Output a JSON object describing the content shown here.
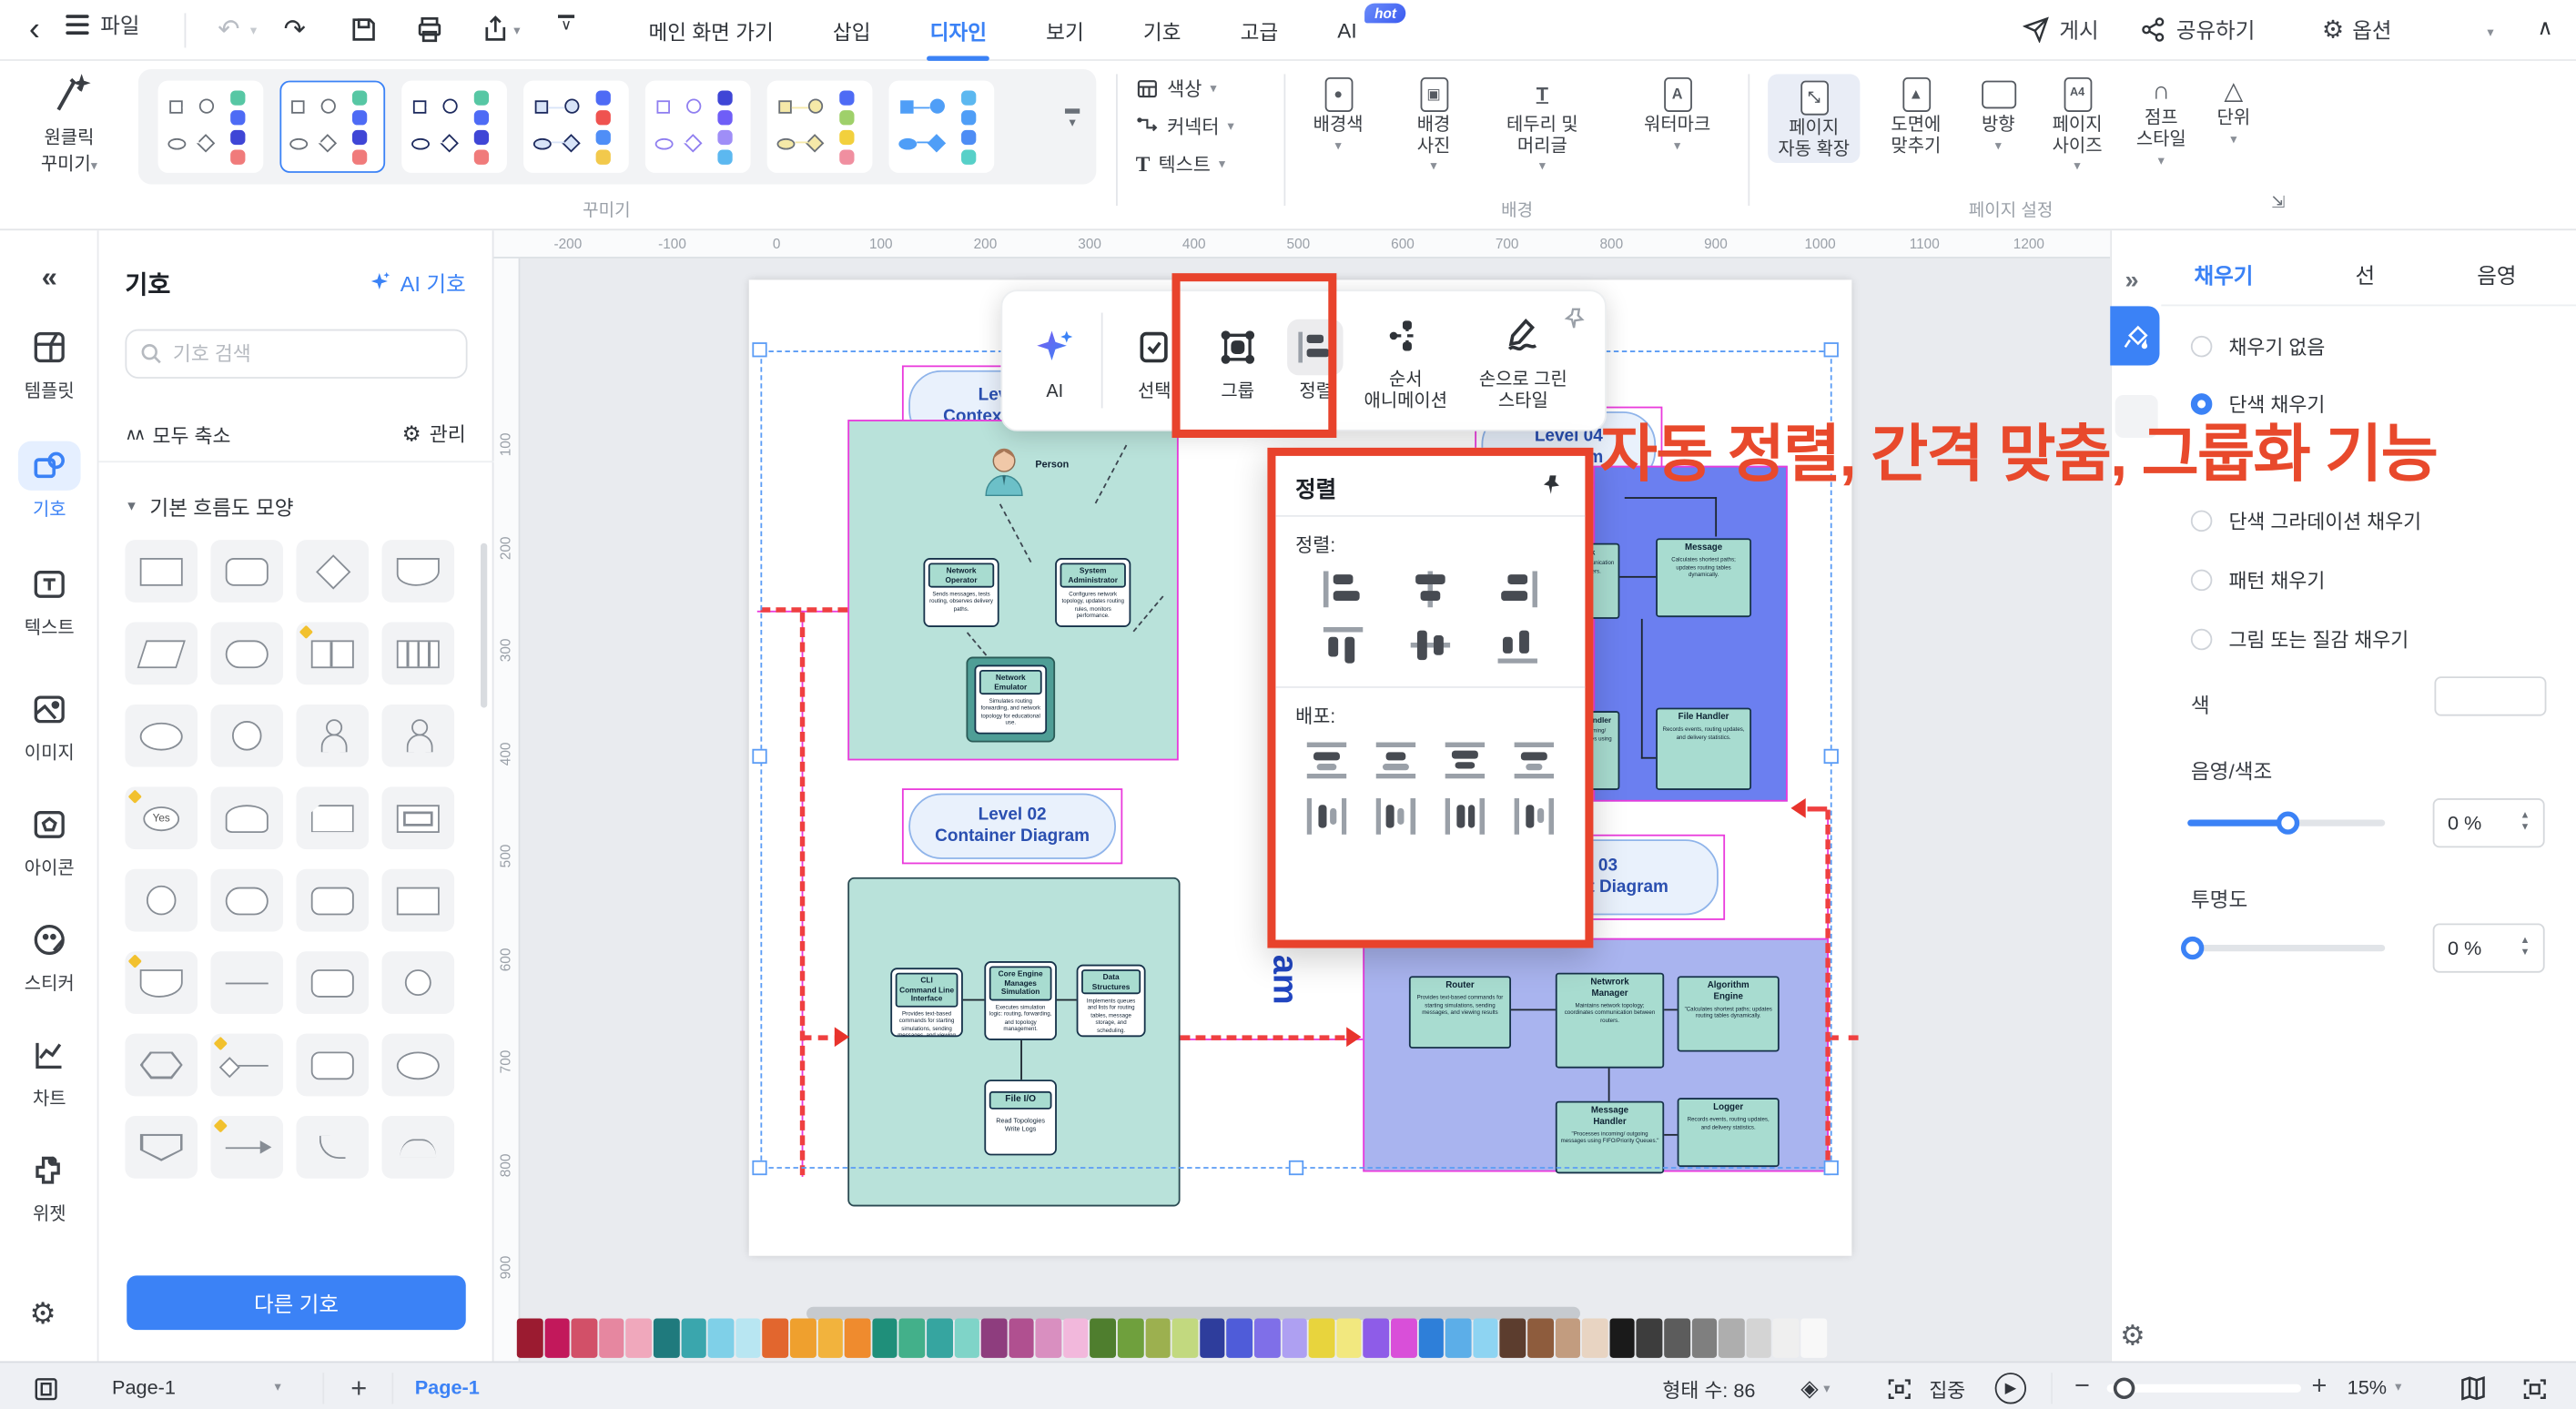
{
  "theme": {
    "accent": "#3b82f6",
    "magenta": "#ea3bdc",
    "red_dash": "#ef4040",
    "annotation_red": "#e8492c"
  },
  "topbar": {
    "file": "파일",
    "tabs": [
      {
        "label": "메인 화면 가기"
      },
      {
        "label": "삽입"
      },
      {
        "label": "디자인"
      },
      {
        "label": "보기"
      },
      {
        "label": "기호"
      },
      {
        "label": "고급"
      },
      {
        "label": "AI"
      }
    ],
    "ai_badge": "hot",
    "publish": "게시",
    "share": "공유하기",
    "options": "옵션",
    "help": "?",
    "glyphs": {
      "back": "‹",
      "undo": "↶",
      "redo": "↷",
      "caret": "▾",
      "collapse_up": "∧",
      "gear": "⚙"
    }
  },
  "ribbon": {
    "oneclick": "원클릭\n꾸미기",
    "decorate_group": "꾸미기",
    "bg_group": "배경",
    "page_group": "페이지 설정",
    "color": "색상",
    "connector": "커넥터",
    "text": "텍스트",
    "bg_color": "배경색",
    "bg_photo": "배경\n사진",
    "border_header": "테두리 및\n머리글",
    "watermark": "워터마크",
    "auto_expand": "페이지\n자동 확장",
    "fit_drawing": "도면에\n맞추기",
    "orientation": "방향",
    "page_size": "페이지\n사이즈",
    "jump_style": "점프\n스타일",
    "unit": "단위",
    "presets": [
      {
        "style": "st-outline-gray",
        "selected": false,
        "dots": [
          "#57c7a4",
          "#4e6bf5",
          "#3f46d6",
          "#f07b7b"
        ]
      },
      {
        "style": "st-outline-gray",
        "selected": true,
        "dots": [
          "#57c7a4",
          "#4e6bf5",
          "#3f46d6",
          "#f07b7b"
        ]
      },
      {
        "style": "st-outline-navy",
        "selected": false,
        "dots": [
          "#57c7a4",
          "#4e6bf5",
          "#3f46d6",
          "#f07b7b"
        ]
      },
      {
        "style": "st-fill-blue-outline",
        "selected": false,
        "dots": [
          "#4e6bf5",
          "#ef5350",
          "#4f8ef7",
          "#f2c94c"
        ]
      },
      {
        "style": "st-outline-purple",
        "selected": false,
        "dots": [
          "#3f46d6",
          "#6f5ef7",
          "#9f8ef7",
          "#5cb8f0"
        ]
      },
      {
        "style": "st-fill-yellow",
        "selected": false,
        "dots": [
          "#4e6bf5",
          "#9fd06a",
          "#f2d03d",
          "#f08fa0"
        ]
      },
      {
        "style": "st-fill-blue",
        "selected": false,
        "dots": [
          "#5cb8f0",
          "#4f9ef7",
          "#4e8df5",
          "#57d0c8"
        ]
      }
    ]
  },
  "sidebar": {
    "collapse": "«",
    "items": [
      {
        "label": "템플릿",
        "icon": "template-icon"
      },
      {
        "label": "기호",
        "icon": "symbols-icon",
        "active": true
      },
      {
        "label": "텍스트",
        "icon": "text-icon"
      },
      {
        "label": "이미지",
        "icon": "image-icon"
      },
      {
        "label": "아이콘",
        "icon": "icons-icon"
      },
      {
        "label": "스티커",
        "icon": "sticker-icon"
      },
      {
        "label": "차트",
        "icon": "chart-icon"
      },
      {
        "label": "위젯",
        "icon": "widget-icon"
      }
    ]
  },
  "symbol_panel": {
    "title": "기호",
    "ai": "AI 기호",
    "search_placeholder": "기호 검색",
    "collapse_all": "모두 축소",
    "manage": "관리",
    "section": "기본 흐름도 모양",
    "more": "다른 기호",
    "shapes": [
      {
        "t": "rect"
      },
      {
        "t": "rounded"
      },
      {
        "t": "diamond"
      },
      {
        "t": "flag"
      },
      {
        "t": "para"
      },
      {
        "t": "stadium"
      },
      {
        "t": "split",
        "b": true
      },
      {
        "t": "striped"
      },
      {
        "t": "ellipse"
      },
      {
        "t": "circle"
      },
      {
        "t": "person"
      },
      {
        "t": "person"
      },
      {
        "t": "yes",
        "label": "Yes",
        "b": true
      },
      {
        "t": "cylinder"
      },
      {
        "t": "card"
      },
      {
        "t": "frame"
      },
      {
        "t": "circle"
      },
      {
        "t": "stadium"
      },
      {
        "t": "rounded"
      },
      {
        "t": "rect"
      },
      {
        "t": "flag",
        "b": true
      },
      {
        "t": "hline"
      },
      {
        "t": "rounded"
      },
      {
        "t": "ring"
      },
      {
        "t": "hex"
      },
      {
        "t": "dline",
        "b": true
      },
      {
        "t": "rounded"
      },
      {
        "t": "ellipse"
      },
      {
        "t": "shield"
      },
      {
        "t": "arrow",
        "b": true
      },
      {
        "t": "hook"
      },
      {
        "t": "arc"
      }
    ]
  },
  "canvas": {
    "h_ruler": [
      "-200",
      "-100",
      "0",
      "100",
      "200",
      "300",
      "400",
      "500",
      "600",
      "700",
      "800",
      "900",
      "1000",
      "1100",
      "1200"
    ],
    "v_ruler": [
      "100",
      "200",
      "300",
      "400",
      "500",
      "600",
      "700",
      "800",
      "900"
    ],
    "diagrams": {
      "level01": {
        "title": "Level 01\nContext Diagram",
        "person": "Person",
        "nodes": [
          {
            "title": "Network\nOperator",
            "desc": "Sends messages, tests routing, observes delivery paths."
          },
          {
            "title": "System\nAdministrator",
            "desc": "Configures network topology, updates routing rules, monitors performance."
          },
          {
            "title": "Network\nEmulator",
            "desc": "Simulates routing forwarding, and network topology for educational use."
          }
        ]
      },
      "level02": {
        "title": "Level 02\nContainer Diagram",
        "nodes": [
          {
            "title": "CLI\nCommand Line\nInterface",
            "desc": "Provides text-based commands for starting simulations, sending messages, and viewing results."
          },
          {
            "title": "Core Engine\nManages\nSimulation",
            "desc": "Executes simulation logic: routing, forwarding, and topology management."
          },
          {
            "title": "Data\nStructures",
            "desc": "Implements queues and lists for routing tables, message storage, and scheduling."
          },
          {
            "title": "File I/O",
            "desc": "Read Topologies\nWrite Logs"
          }
        ]
      },
      "level04": {
        "title": "Level 04\nDiagram",
        "nodes": [
          {
            "title": "Message",
            "desc": "Calculates shortest paths; updates routing tables dynamically."
          },
          {
            "title": "File Handler",
            "desc": "Records events, routing updates, and delivery statistics."
          },
          {
            "title": "Network",
            "desc": "coordinates communication between routers."
          },
          {
            "title": "Message Handler",
            "desc": "Processes incoming/ outgoing messages using queues."
          }
        ]
      },
      "level03": {
        "title": "Level 03\nComponent Diagram",
        "nodes": [
          {
            "title": "Router",
            "desc": "Provides text-based commands for starting simulations, sending messages, and viewing results"
          },
          {
            "title": "Netwrork\nManager",
            "desc": "Maintains network topology; coordinates communication between routers."
          },
          {
            "title": "Algorithm\nEngine",
            "desc": "\"Calculates shortest paths; updates routing tables dynamically."
          },
          {
            "title": "Message\nHandler",
            "desc": "\"Processes incoming/ outgoing messages using FIFO/Priority Queues.\""
          },
          {
            "title": "Logger",
            "desc": "Records events, routing updates, and delivery statistics."
          }
        ]
      }
    },
    "overlay_text": "am"
  },
  "float_toolbar": {
    "ai": "AI",
    "select": "선택",
    "group": "그룹",
    "align": "정렬",
    "order": "순서\n애니메이션",
    "hand": "손으로 그린\n스타일"
  },
  "align_popup": {
    "title": "정렬",
    "align_label": "정렬:",
    "distribute_label": "배포:"
  },
  "annotation": {
    "text": "자동 정렬, 간격 맞춤, 그룹화 기능",
    "color": "#e8492c"
  },
  "right_panel": {
    "tabs": [
      {
        "label": "채우기",
        "active": true
      },
      {
        "label": "선",
        "active": false
      },
      {
        "label": "음영",
        "active": false
      }
    ],
    "fill_options": [
      {
        "label": "채우기 없음",
        "selected": false
      },
      {
        "label": "단색 채우기",
        "selected": true
      },
      {
        "label": "단색 그라데이션 채우기",
        "selected": false
      },
      {
        "label": "패턴 채우기",
        "selected": false
      },
      {
        "label": "그림 또는 질감 채우기",
        "selected": false
      }
    ],
    "color_label": "색",
    "shade_label": "음영/색조",
    "shade_value": "0 %",
    "transparency_label": "투명도",
    "transparency_value": "0 %"
  },
  "statusbar": {
    "page_select": "Page-1",
    "page_tab": "Page-1",
    "shape_count": "형태 수: 86",
    "focus": "집중",
    "zoom": "15%"
  },
  "palette": {
    "colors": [
      "#9b1b30",
      "#c2185b",
      "#d25068",
      "#e687a0",
      "#f0a8bc",
      "#1f7a7d",
      "#3aa6ad",
      "#7fd0e8",
      "#b8e6f2",
      "#e2662e",
      "#efa02e",
      "#f2b33d",
      "#ef8b2e",
      "#1f8f7a",
      "#43b08a",
      "#36a5a0",
      "#7fd4c8",
      "#8e3d7e",
      "#b05090",
      "#d98fc0",
      "#f2b8dc",
      "#4f7e2e",
      "#6fa03d",
      "#9cb04f",
      "#c2d97f",
      "#2e3d9c",
      "#4f5cd9",
      "#7f6fe8",
      "#aea0f2",
      "#e8d43d",
      "#f2e87f",
      "#8e5ce8",
      "#d94fd9",
      "#2e7fd9",
      "#5caee8",
      "#8ed4f2",
      "#5c3d2e",
      "#8e5c3d",
      "#c29c7f",
      "#e8d4c2",
      "#1a1a1a",
      "#3d3d3d",
      "#5c5c5c",
      "#7f7f7f",
      "#aeaeae",
      "#d4d4d4",
      "#efefef",
      "#f8f8f8"
    ]
  }
}
